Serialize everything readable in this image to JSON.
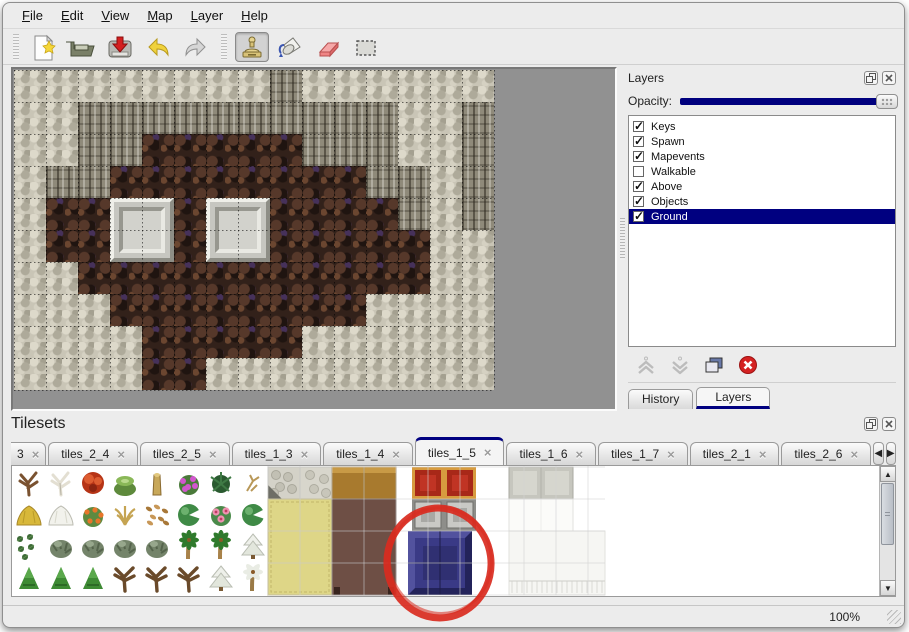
{
  "menu": {
    "items": [
      "File",
      "Edit",
      "View",
      "Map",
      "Layer",
      "Help"
    ]
  },
  "toolbar": {
    "buttons": [
      {
        "name": "new",
        "active": false
      },
      {
        "name": "open",
        "active": false
      },
      {
        "name": "save",
        "active": false
      },
      {
        "name": "undo",
        "active": false
      },
      {
        "name": "redo",
        "active": false
      },
      {
        "name": "stamp",
        "active": true
      },
      {
        "name": "fill",
        "active": false
      },
      {
        "name": "eraser",
        "active": false
      },
      {
        "name": "select",
        "active": false
      }
    ]
  },
  "layers_panel": {
    "title": "Layers",
    "opacity_label": "Opacity:",
    "opacity_percent": 100,
    "layers": [
      {
        "name": "Keys",
        "checked": true,
        "selected": false
      },
      {
        "name": "Spawn",
        "checked": true,
        "selected": false
      },
      {
        "name": "Mapevents",
        "checked": true,
        "selected": false
      },
      {
        "name": "Walkable",
        "checked": false,
        "selected": false
      },
      {
        "name": "Above",
        "checked": true,
        "selected": false
      },
      {
        "name": "Objects",
        "checked": true,
        "selected": false
      },
      {
        "name": "Ground",
        "checked": true,
        "selected": true
      }
    ],
    "tools": [
      "raise-layer",
      "lower-layer",
      "duplicate-layer",
      "delete-layer"
    ],
    "tabs": [
      {
        "label": "History",
        "active": false
      },
      {
        "label": "Layers",
        "active": true
      }
    ]
  },
  "tilesets_panel": {
    "title": "Tilesets",
    "tabs": [
      {
        "label": "3",
        "active": false,
        "partial": true
      },
      {
        "label": "tiles_2_4",
        "active": false
      },
      {
        "label": "tiles_2_5",
        "active": false
      },
      {
        "label": "tiles_1_3",
        "active": false
      },
      {
        "label": "tiles_1_4",
        "active": false
      },
      {
        "label": "tiles_1_5",
        "active": true
      },
      {
        "label": "tiles_1_6",
        "active": false
      },
      {
        "label": "tiles_1_7",
        "active": false
      },
      {
        "label": "tiles_2_1",
        "active": false
      },
      {
        "label": "tiles_2_6",
        "active": false
      }
    ],
    "plants": [
      [
        "bare-tree",
        "white-tree",
        "red-flower",
        "stump",
        "trunk",
        "purple-bush",
        "fern",
        "twig"
      ],
      [
        "hay",
        "snow-mound",
        "orange-flowers",
        "grass-tuft",
        "leaves",
        "lilypad",
        "pink-flower",
        "lilypad"
      ],
      [
        "sprigs",
        "bush",
        "bush",
        "bush",
        "bush",
        "palm",
        "palm",
        "snow-pine"
      ],
      [
        "cone-bush",
        "cone-bush",
        "cone-bush",
        "dead-tree",
        "dead-tree",
        "dead-tree",
        "snow-pine",
        "snow-palm"
      ]
    ],
    "furniture": [
      {
        "kind": "stone",
        "x": 256,
        "y": 0,
        "w": 32,
        "h": 32
      },
      {
        "kind": "stone2",
        "x": 288,
        "y": 0,
        "w": 32,
        "h": 32
      },
      {
        "kind": "mat",
        "x": 256,
        "y": 32,
        "w": 64,
        "h": 96
      },
      {
        "kind": "tabletop",
        "x": 320,
        "y": 0,
        "w": 64,
        "h": 32
      },
      {
        "kind": "maroon",
        "x": 320,
        "y": 32,
        "w": 64,
        "h": 96
      },
      {
        "kind": "carpet",
        "x": 400,
        "y": 0,
        "w": 32,
        "h": 32
      },
      {
        "kind": "carpet",
        "x": 432,
        "y": 0,
        "w": 32,
        "h": 32
      },
      {
        "kind": "silver",
        "x": 400,
        "y": 32,
        "w": 32,
        "h": 32
      },
      {
        "kind": "silver",
        "x": 432,
        "y": 32,
        "w": 32,
        "h": 32
      },
      {
        "kind": "blueblock",
        "x": 396,
        "y": 64,
        "w": 64,
        "h": 64
      },
      {
        "kind": "graytile",
        "x": 497,
        "y": 0,
        "w": 64,
        "h": 32
      },
      {
        "kind": "whitetile",
        "x": 497,
        "y": 32,
        "w": 64,
        "h": 32
      },
      {
        "kind": "curtain",
        "x": 497,
        "y": 64,
        "w": 96,
        "h": 64
      }
    ],
    "annotation": {
      "shape": "ellipse",
      "color": "#d92b1f",
      "cx": 60,
      "cy": 64,
      "rx": 52,
      "ry": 55
    }
  },
  "map": {
    "tile_size": 32,
    "cols": 15,
    "rows": 10,
    "legend": {
      "R": "light-rock",
      "C": "cliff-face",
      "F": "brown-floor"
    },
    "grid": [
      "RRRRRRRRCRRRRRR",
      "RRCCCCCCCCCCRRC",
      "RRCCFFFFFCCCRRC",
      "RCCFFFFFFFFCCRC",
      "RFFFFFFFFFFFCRC",
      "RFFFFFFFFFFFFRR",
      "RRFFFFFFFFFFFRR",
      "RRRFFFFFFFFRRRR",
      "RRRRFFFFFRRRRRR",
      "RRRRFFRRRRRRRRR"
    ],
    "platforms": [
      {
        "col": 3,
        "row": 4,
        "span": 2
      },
      {
        "col": 6,
        "row": 4,
        "span": 2
      }
    ]
  },
  "status": {
    "zoom_level": "100%"
  },
  "colors": {
    "accent": "#000080",
    "selection_bg": "#000080",
    "annotation_red": "#d92b1f",
    "canvas_bg": "#919191",
    "panel_bg": "#ececec"
  }
}
